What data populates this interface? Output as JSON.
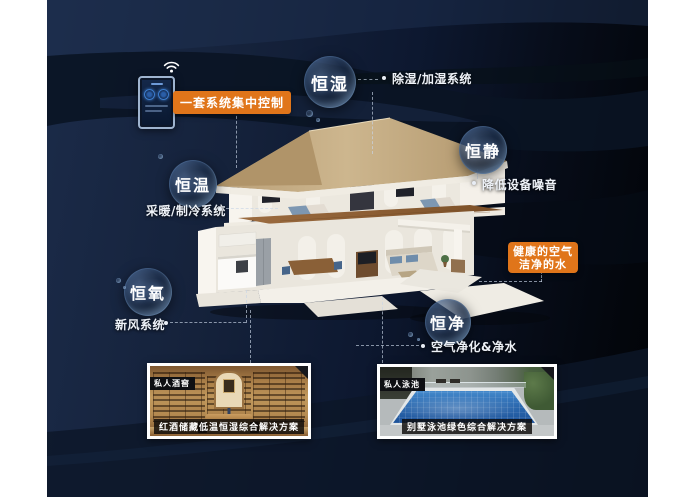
{
  "control_panel": {
    "label": "一套系统集中控制"
  },
  "bubbles": [
    {
      "label": "恒湿",
      "desc": "除湿/加湿系统"
    },
    {
      "label": "恒静",
      "desc": "降低设备噪音"
    },
    {
      "label": "恒温",
      "desc": "采暖/制冷系统"
    },
    {
      "label": "恒氧",
      "desc": "新风系统"
    },
    {
      "label": "恒净",
      "desc": "空气净化&净水"
    }
  ],
  "highlight_box": {
    "line1": "健康的空气",
    "line2": "洁净的水"
  },
  "cards": [
    {
      "tag": "私人酒窖",
      "caption": "红酒储藏低温恒湿综合解决方案"
    },
    {
      "tag": "私人泳池",
      "caption": "别墅泳池绿色综合解决方案"
    }
  ],
  "icons": {
    "phone": "smartphone-icon",
    "wifi": "wifi-icon"
  },
  "colors": {
    "accent_orange": "#e0751a",
    "canvas_navy": "#111d33",
    "bubble_rim": "#9fc3e8",
    "tag_black": "#0e0f13"
  }
}
